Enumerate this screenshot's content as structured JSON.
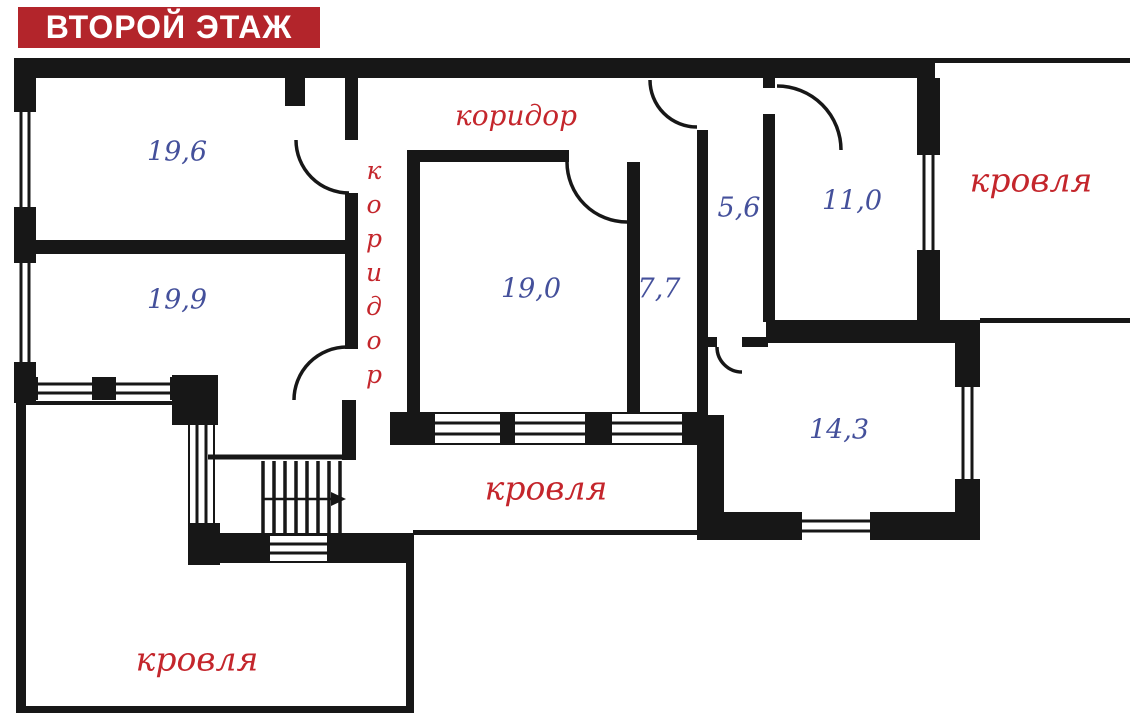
{
  "title_banner": {
    "text": "ВТОРОЙ ЭТАЖ"
  },
  "corridors": {
    "horizontal_label": "коридор",
    "vertical_label": "коридор"
  },
  "roof_areas": {
    "top_right_label": "кровля",
    "middle_label": "кровля",
    "bottom_left_label": "кровля"
  },
  "rooms": [
    {
      "id": "room-19-6",
      "area_m2": "19,6"
    },
    {
      "id": "room-19-9",
      "area_m2": "19,9"
    },
    {
      "id": "room-19-0",
      "area_m2": "19,0"
    },
    {
      "id": "room-7-7",
      "area_m2": "7,7"
    },
    {
      "id": "room-5-6",
      "area_m2": "5,6"
    },
    {
      "id": "room-11-0",
      "area_m2": "11,0"
    },
    {
      "id": "room-14-3",
      "area_m2": "14,3"
    }
  ],
  "colors": {
    "wall": "#171717",
    "room_area_text": "#44509b",
    "red_label": "#c4262c",
    "banner_background": "#b3252b",
    "banner_text": "#ffffff"
  }
}
